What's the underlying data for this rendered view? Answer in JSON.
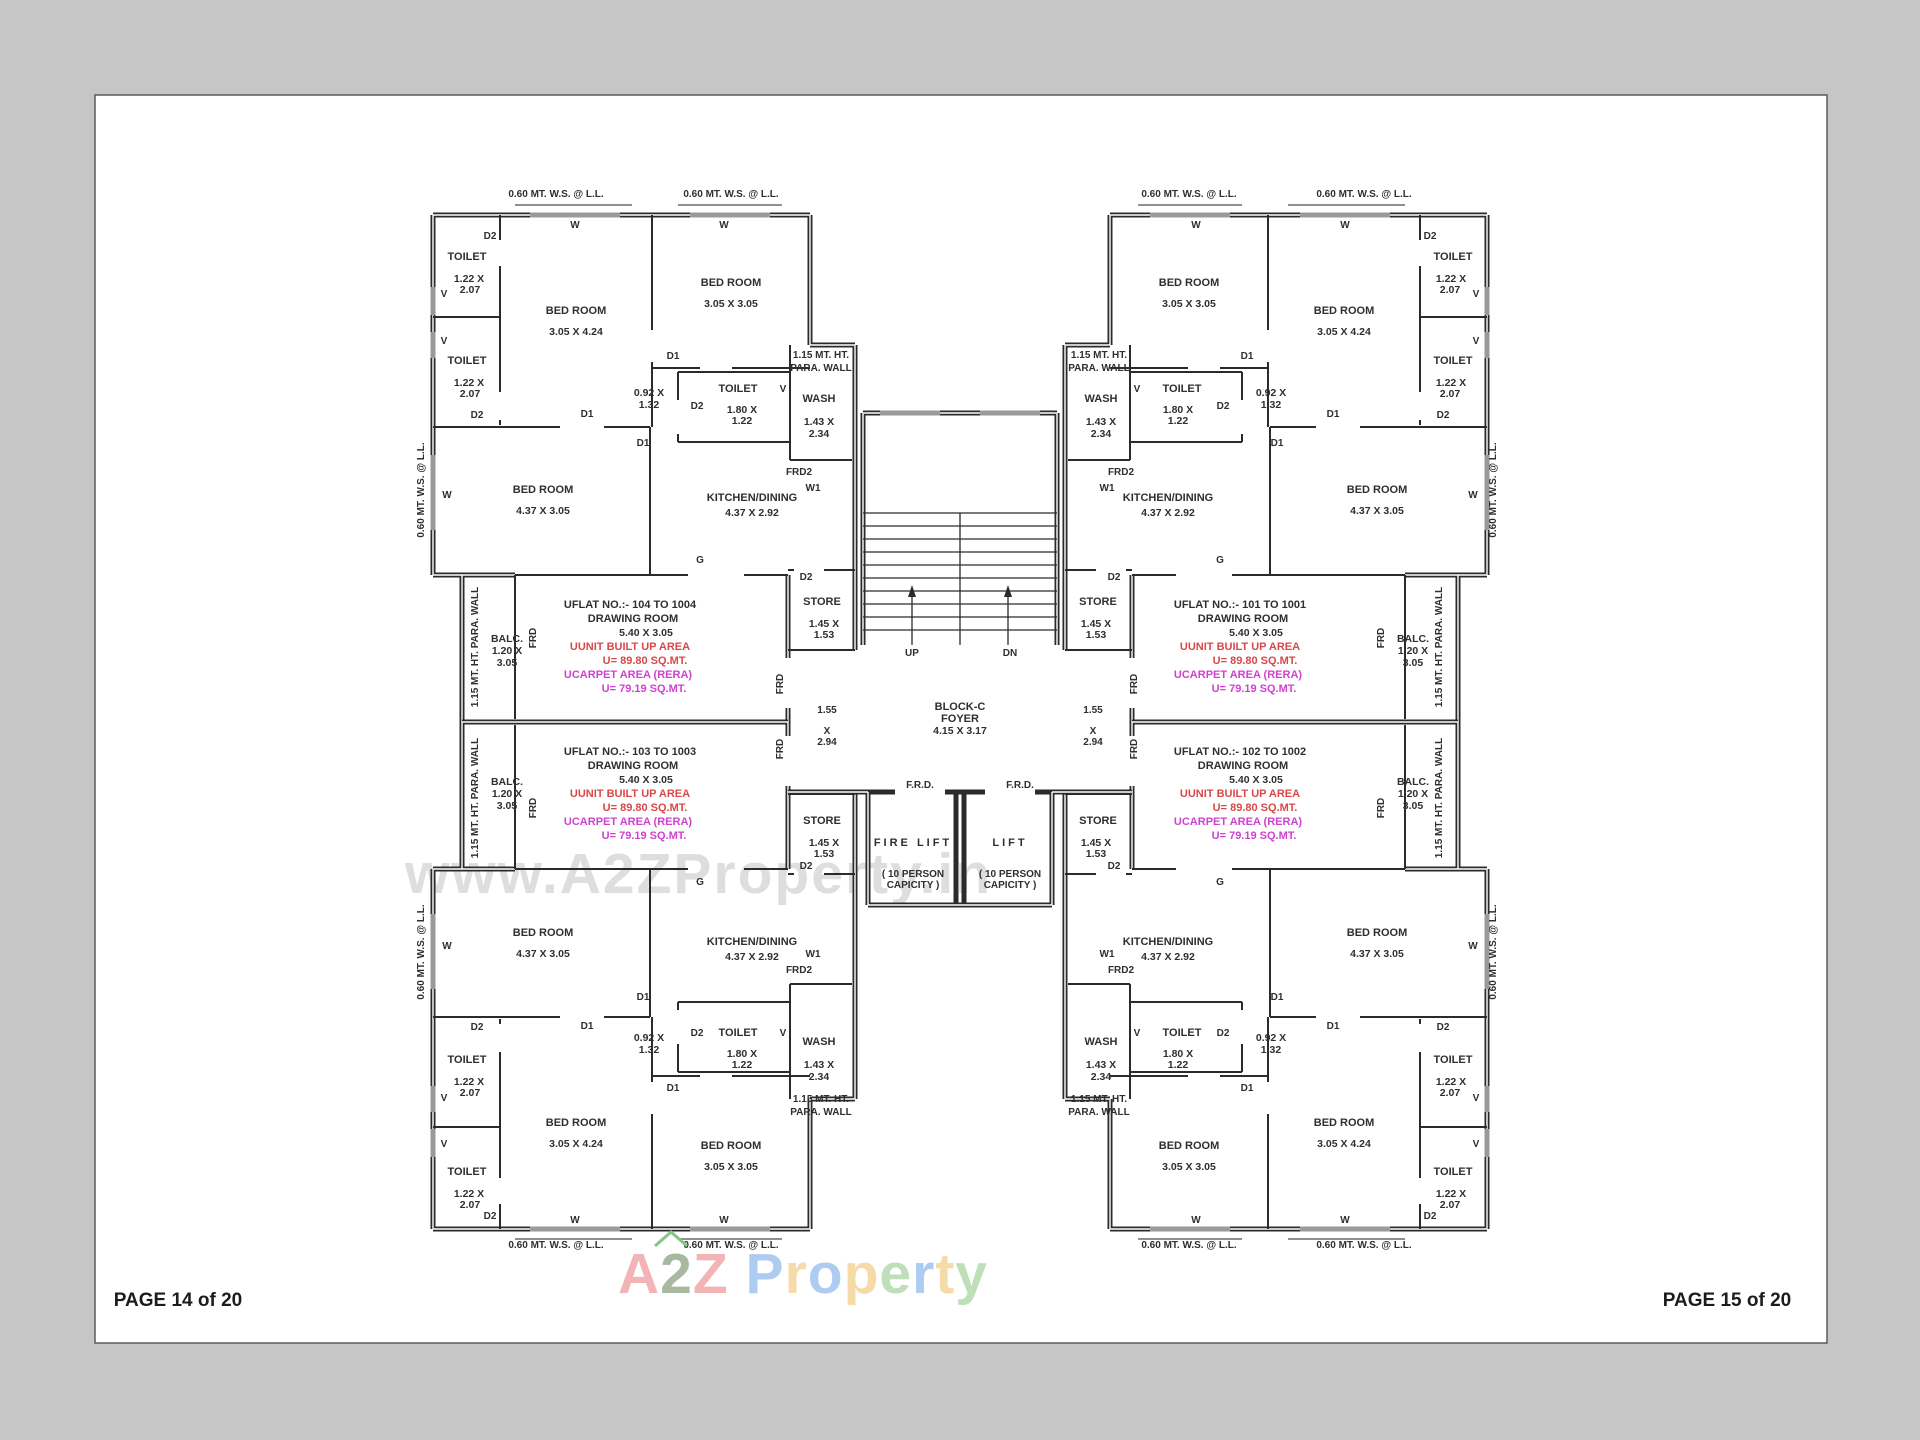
{
  "footer": {
    "left": "PAGE 14 of 20",
    "right": "PAGE 15 of 20"
  },
  "watermark": "www.A2ZProperty.in",
  "logo": {
    "a": "A",
    "two": "2",
    "z": "Z",
    "word": [
      "P",
      "r",
      "o",
      "p",
      "e",
      "r",
      "t",
      "y"
    ],
    "a_color": "#f2b4b4",
    "two_color": "#a9b9a1",
    "z_color": "#f2b4b4",
    "word_colors": [
      "#aecbf2",
      "#f6daa8",
      "#aecbf2",
      "#f6daa8",
      "#bedfb8",
      "#aecbf2",
      "#f6daa8",
      "#bedfb8"
    ]
  },
  "colors": {
    "background": "#c6c6c6",
    "paper": "#ffffff",
    "wall": "#2b2b2b",
    "built_up_text": "#d94848",
    "carpet_text": "#cf42cf",
    "watermark": "#dedede"
  },
  "labels": {
    "ws": "0.60 MT. W.S. @ L.L.",
    "para_line1": "1.15  MT. HT.",
    "para_line2": "PARA. WALL",
    "para_vert": "1.15  MT. HT. PARA. WALL",
    "bed_room": "BED ROOM",
    "toilet": "TOILET",
    "wash": "WASH",
    "kitchen": "KITCHEN/DINING",
    "store": "STORE",
    "balc": "BALC.",
    "drawing_room": "DRAWING ROOM",
    "built_up": "UUNIT BUILT UP AREA",
    "built_up_val": "U= 89.80 SQ.MT.",
    "carpet": "UCARPET AREA (RERA)",
    "carpet_val": "U= 79.19 SQ.MT.",
    "block_name": "BLOCK-C",
    "foyer": "FOYER",
    "foyer_dim": "4.15 X 3.17",
    "fire_lift": "FIRE LIFT",
    "lift": "LIFT",
    "person1": "( 10 PERSON",
    "person2": "CAPICITY )",
    "frd_dot": "F.R.D.",
    "up": "UP",
    "dn": "DN",
    "g": "G",
    "frd": "FRD",
    "frd2": "FRD2",
    "w1": "W1",
    "w": "W",
    "v": "V",
    "d1": "D1",
    "d2": "D2"
  },
  "dims": {
    "toilet_w": "1.22 X",
    "toilet_h": "2.07",
    "toilet2_w": "1.80 X",
    "toilet2_h": "1.22",
    "bed_a": "3.05 X 4.24",
    "bed_b": "3.05 X 3.05",
    "bed_c": "4.37 X 3.05",
    "kitchen": "4.37 X 2.92",
    "wash_w": "1.43 X",
    "wash_h": "2.34",
    "store_w": "1.45 X",
    "store_h": "1.53",
    "balc_w": "1.20 X",
    "balc_h": "3.05",
    "lobby_w": "0.92 X",
    "lobby_h": "1.32",
    "pass_w": "1.55",
    "pass_x": "X",
    "pass_h": "2.94",
    "drawing": "5.40 X 3.05"
  },
  "flats": {
    "tl": "UFLAT NO.:- 104 TO 1004",
    "tr": "UFLAT NO.:- 101 TO 1001",
    "bl": "UFLAT NO.:- 103 TO 1003",
    "br": "UFLAT NO.:- 102 TO 1002"
  }
}
